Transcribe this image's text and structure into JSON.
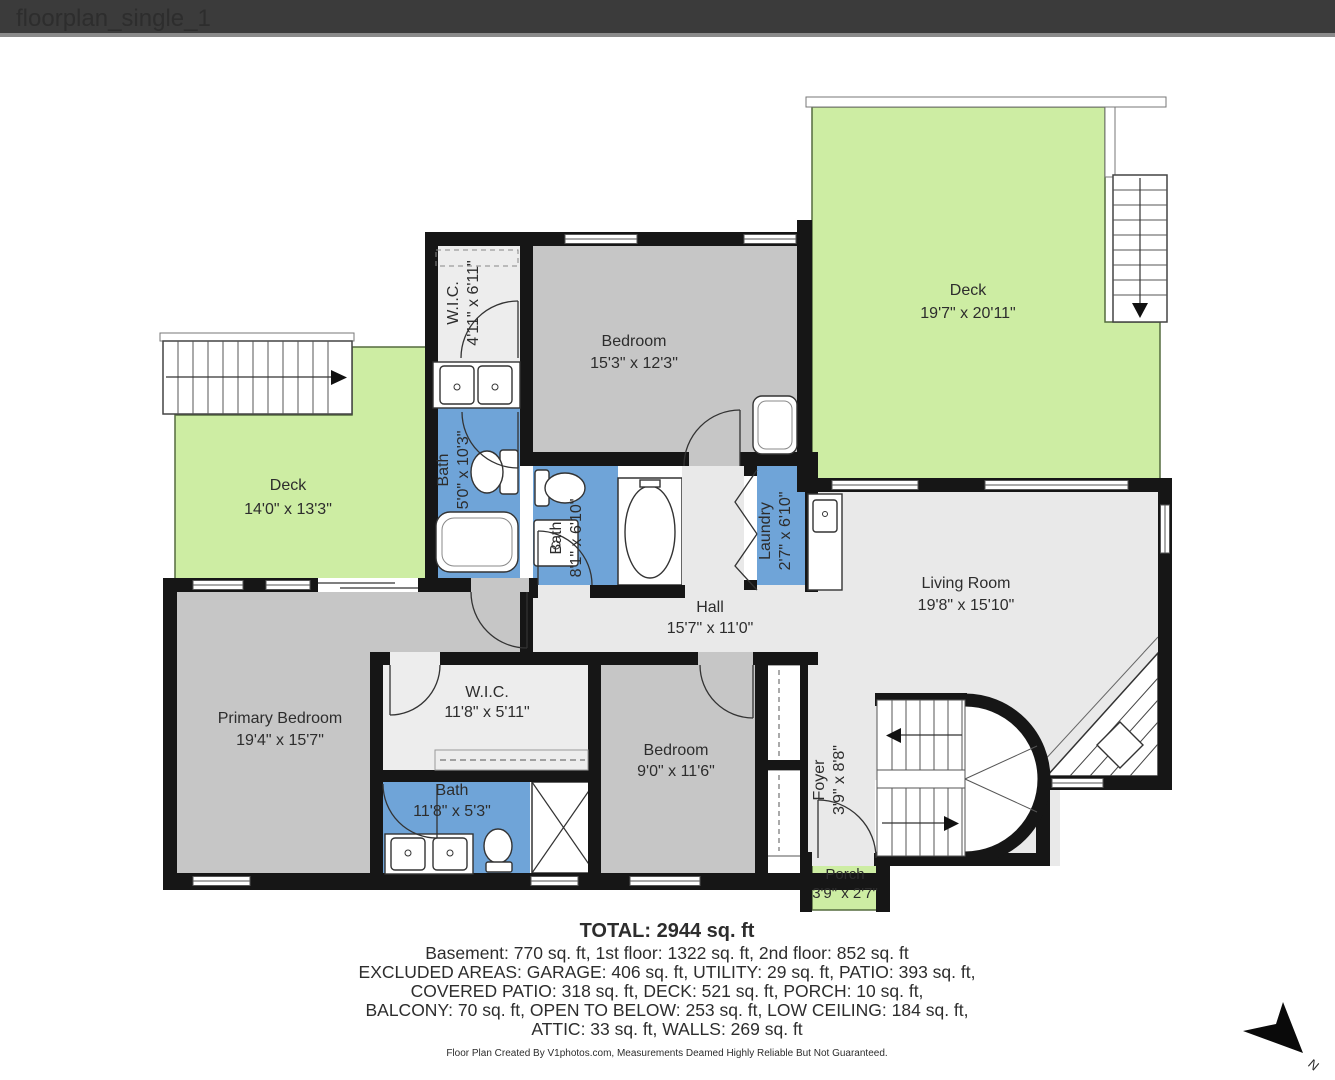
{
  "window": {
    "title": "floorplan_single_1"
  },
  "colors": {
    "titlebar_bg": "#3b3b3b",
    "titlebar_text": "#f2f2f2",
    "deck_green": "#cdeda3",
    "bath_blue": "#6fa4d8",
    "bedroom_gray": "#c6c6c6",
    "hall_gray": "#e9e9e9",
    "wic_gray": "#ededed",
    "wall_black": "#161616"
  },
  "rooms": [
    {
      "name": "W.I.C.",
      "dims": "4'11\" x 6'11\""
    },
    {
      "name": "Bedroom",
      "dims": "15'3\" x 12'3\""
    },
    {
      "name": "Deck",
      "dims": "19'7\" x 20'11\""
    },
    {
      "name": "Deck",
      "dims": "14'0\" x 13'3\""
    },
    {
      "name": "Bath",
      "dims": "5'0\" x 10'3\""
    },
    {
      "name": "Bath",
      "dims": "8'1\" x 6'10\""
    },
    {
      "name": "Laundry",
      "dims": "2'7\" x 6'10\""
    },
    {
      "name": "Living Room",
      "dims": "19'8\" x 15'10\""
    },
    {
      "name": "Hall",
      "dims": "15'7\" x 11'0\""
    },
    {
      "name": "Primary Bedroom",
      "dims": "19'4\" x 15'7\""
    },
    {
      "name": "W.I.C.",
      "dims": "11'8\" x 5'11\""
    },
    {
      "name": "Bedroom",
      "dims": "9'0\" x 11'6\""
    },
    {
      "name": "Bath",
      "dims": "11'8\" x 5'3\""
    },
    {
      "name": "Foyer",
      "dims": "3'9\" x 8'8\""
    },
    {
      "name": "Porch",
      "dims": "3'9\" x 2'7\""
    }
  ],
  "summary": {
    "total": "TOTAL: 2944 sq. ft",
    "line1": "Basement: 770 sq. ft, 1st floor: 1322 sq. ft, 2nd floor: 852 sq. ft",
    "line2": "EXCLUDED AREAS: GARAGE: 406 sq. ft, UTILITY: 29 sq. ft, PATIO: 393 sq. ft,",
    "line3": "COVERED PATIO: 318 sq. ft, DECK: 521 sq. ft, PORCH: 10 sq. ft,",
    "line4": "BALCONY: 70 sq. ft, OPEN TO BELOW: 253 sq. ft, LOW CEILING: 184 sq. ft,",
    "line5": "ATTIC: 33 sq. ft, WALLS: 269 sq. ft"
  },
  "footer": {
    "credit": "Floor Plan Created By V1photos.com, Measurements Deamed Highly Reliable But Not Guaranteed."
  },
  "compass": {
    "label": "N"
  }
}
